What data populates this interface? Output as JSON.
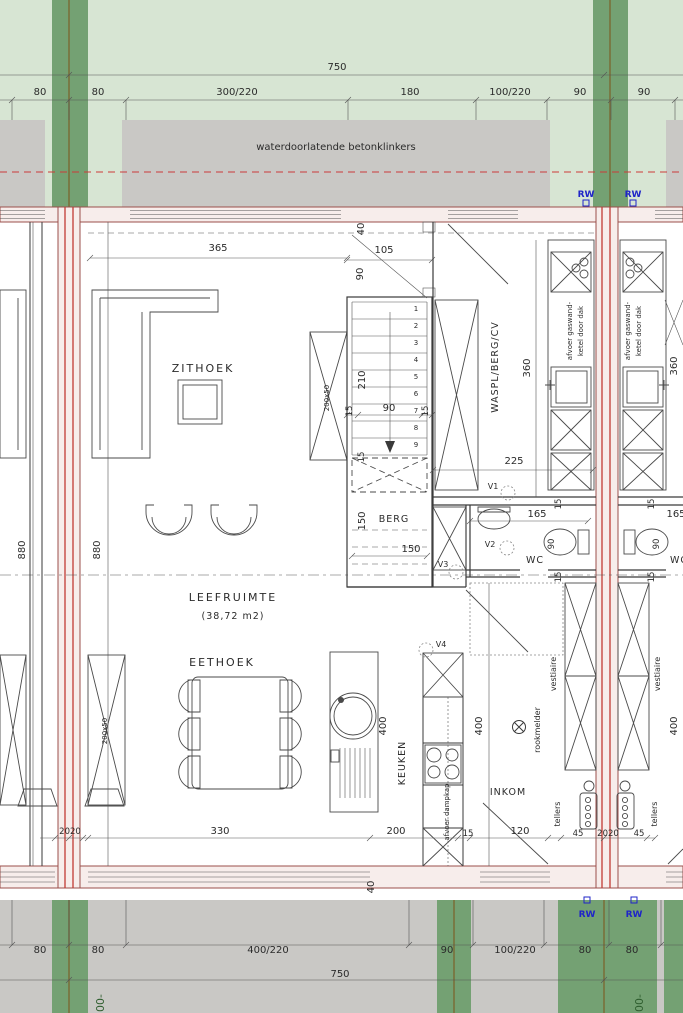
{
  "colors": {
    "site_green": "#d7e5d3",
    "hedge_green": "#74a173",
    "paving_gray": "#c9c8c5",
    "wall_fill": "#f7edeb",
    "party_wall_red": "#c23b34",
    "rw_blue": "#1f24c8"
  },
  "site": {
    "top_total": "750",
    "top_dims": [
      "80",
      "80",
      "300/220",
      "180",
      "100/220",
      "90",
      "90"
    ],
    "paving_label": "waterdoorlatende betonklinkers",
    "rw_label": "RW",
    "bottom_dims": [
      "80",
      "80",
      "400/220",
      "90",
      "100/220",
      "80",
      "80"
    ],
    "bottom_total": "750",
    "level_marker": "00-"
  },
  "rooms": {
    "zithoek": "ZITHOEK",
    "leefruimte": "LEEFRUIMTE",
    "leefruimte_area": "(38,72 m2)",
    "eethoek": "EETHOEK",
    "keuken": "KEUKEN",
    "berg": "BERG",
    "waspl": "WASPL/BERG/CV",
    "wc": "WC",
    "inkom": "INKOM",
    "vestiaire": "vestiaire",
    "tellers": "tellers"
  },
  "annotations": {
    "boiler_line1": "afvoer gaswand-",
    "boiler_line2": "ketel door dak",
    "dampkap": "afvoer dampkap",
    "rookmelder": "rookmelder",
    "v1": "V1",
    "v2": "V2",
    "v3": "V3",
    "v4": "V4",
    "cabinet_size": "200x50"
  },
  "dims": {
    "d365": "365",
    "d105": "105",
    "d90": "90",
    "d40": "40",
    "d210": "210",
    "d15": "15",
    "d150": "150",
    "d880": "880",
    "d225": "225",
    "d165": "165",
    "d360": "360",
    "d400": "400",
    "d330": "330",
    "d200": "200",
    "d120": "120",
    "d45": "45",
    "d2020": "2020"
  },
  "stairs": {
    "steps": [
      "1",
      "2",
      "3",
      "4",
      "5",
      "6",
      "7",
      "8",
      "9"
    ]
  }
}
